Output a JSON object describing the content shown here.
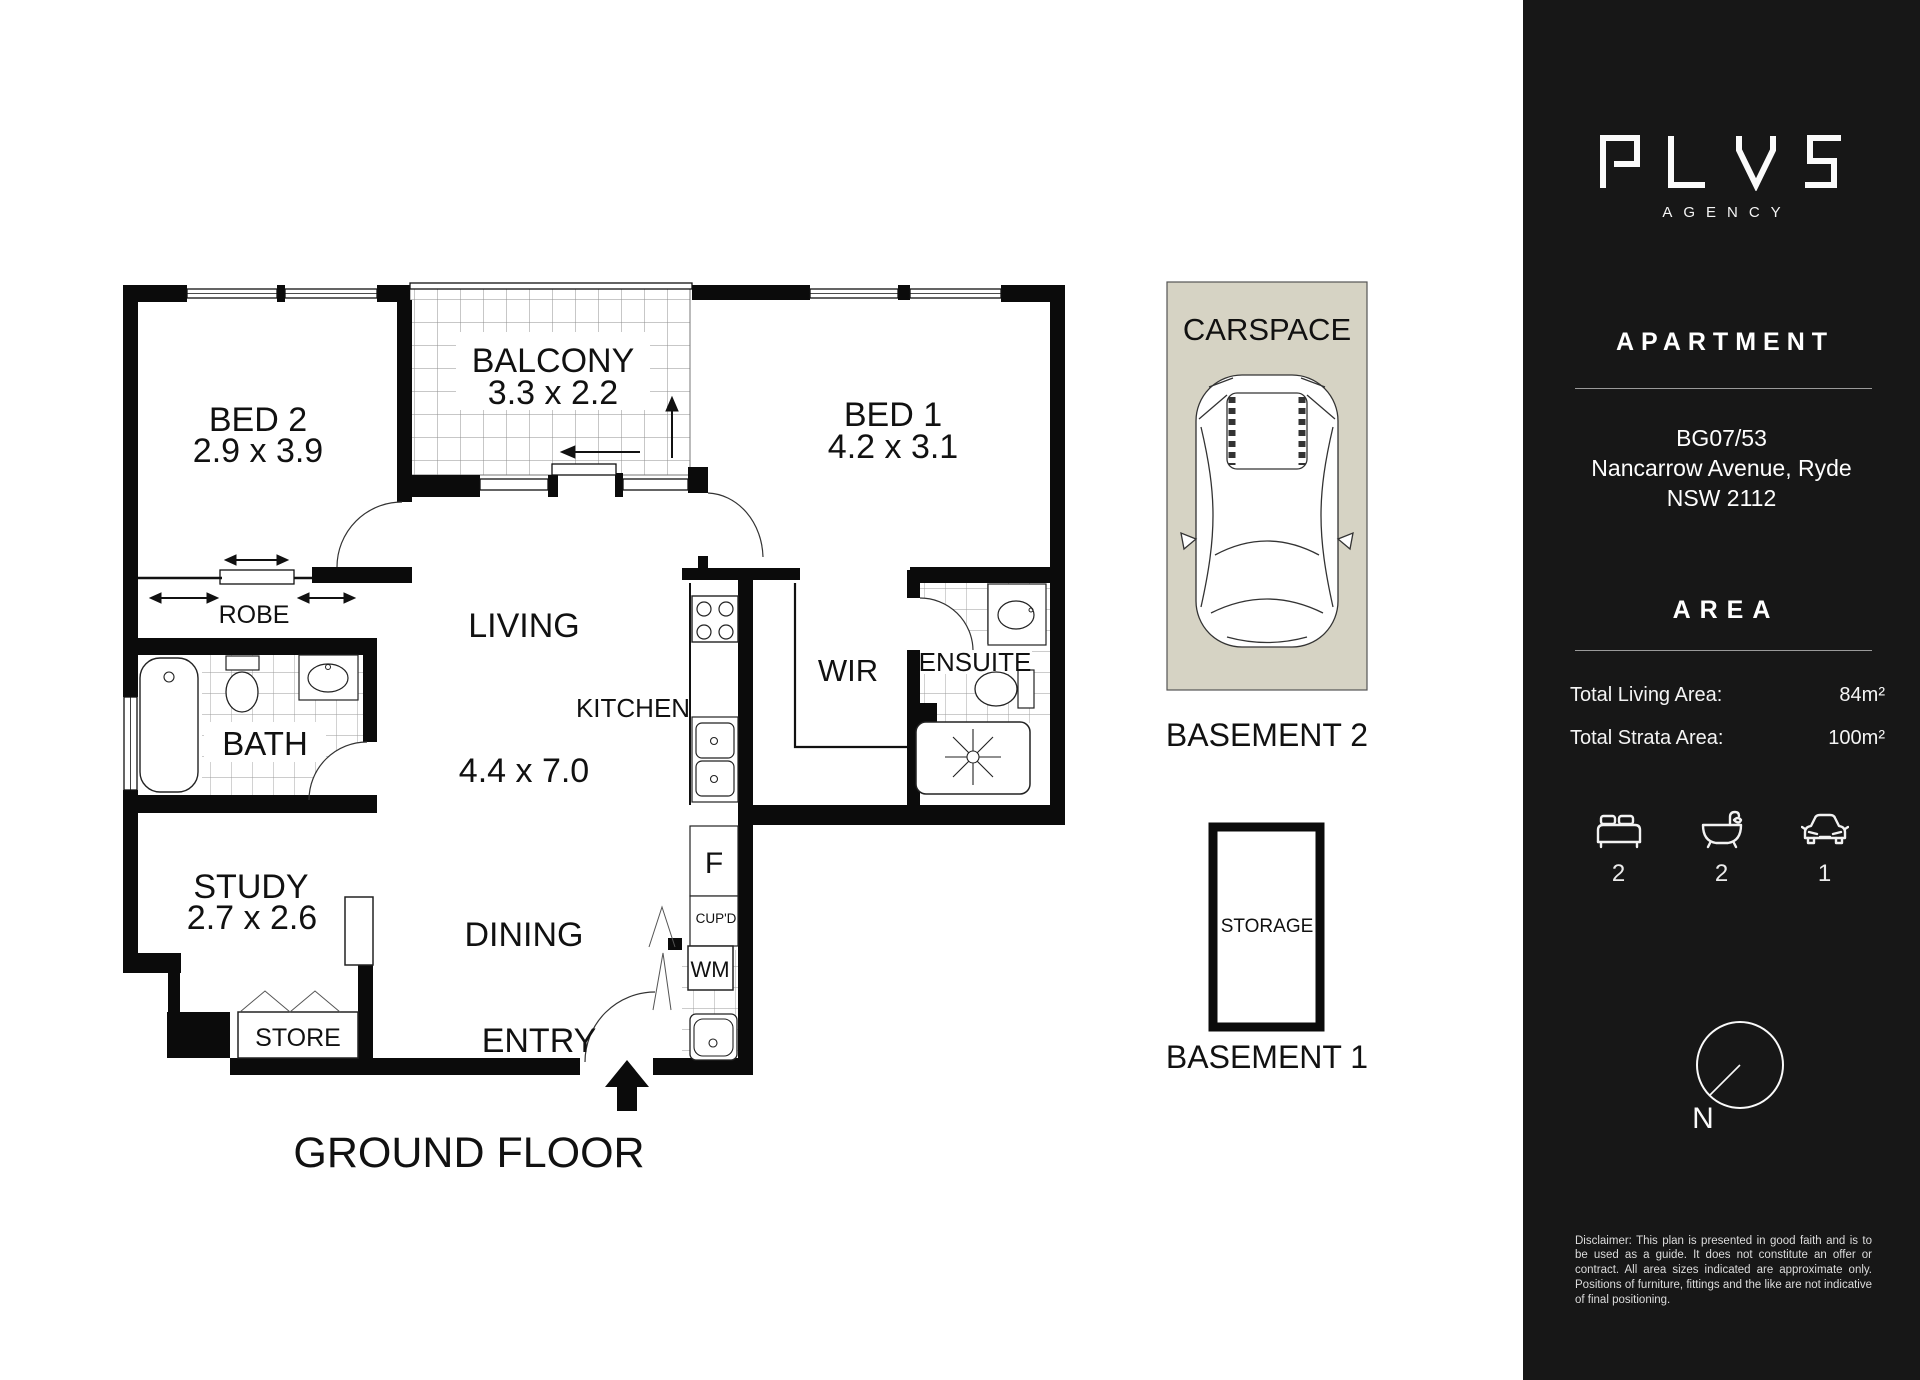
{
  "colors": {
    "sidebar_bg": "#171717",
    "carspace_bg": "#d6d3c4",
    "wall": "#0b0b0b"
  },
  "icons": {
    "brand": "plus-logo-icon",
    "beds": "bed-icon",
    "baths": "bath-icon",
    "cars": "car-icon",
    "compass": "compass-icon",
    "entry": "entry-arrow-icon"
  },
  "plan": {
    "title": "GROUND FLOOR",
    "rooms": {
      "bed2": {
        "label": "BED 2",
        "dims": "2.9 x 3.9"
      },
      "balcony": {
        "label": "BALCONY",
        "dims": "3.3 x 2.2"
      },
      "bed1": {
        "label": "BED 1",
        "dims": "4.2 x 3.1"
      },
      "robe": {
        "label": "ROBE"
      },
      "bath": {
        "label": "BATH"
      },
      "living": {
        "label": "LIVING",
        "dims": "4.4 x 7.0"
      },
      "kitchen": {
        "label": "KITCHEN"
      },
      "wir": {
        "label": "WIR"
      },
      "ensuite": {
        "label": "ENSUITE"
      },
      "study": {
        "label": "STUDY",
        "dims": "2.7 x 2.6"
      },
      "dining": {
        "label": "DINING"
      },
      "store": {
        "label": "STORE"
      },
      "entry": {
        "label": "ENTRY"
      },
      "fridge": {
        "label": "F"
      },
      "cupboard": {
        "label": "CUP'D"
      },
      "washing_machine": {
        "label": "WM"
      }
    },
    "parking": {
      "carspace_label": "CARSPACE",
      "carspace_caption": "BASEMENT 2",
      "storage_label": "STORAGE",
      "storage_caption": "BASEMENT 1"
    }
  },
  "sidebar": {
    "logo": {
      "wordmark": "PLVS",
      "subtitle": "AGENCY"
    },
    "property_type": "APARTMENT",
    "address": {
      "line1": "BG07/53",
      "line2": "Nancarrow Avenue, Ryde",
      "line3": "NSW 2112"
    },
    "area_heading": "AREA",
    "area_rows": [
      {
        "label": "Total Living Area:",
        "value": "84m²"
      },
      {
        "label": "Total Strata Area:",
        "value": "100m²"
      }
    ],
    "stats": {
      "beds": "2",
      "baths": "2",
      "cars": "1"
    },
    "compass_label": "N",
    "disclaimer": "Disclaimer: This plan is presented in good faith and is to be used as a guide. It does not constitute an offer or contract. All area sizes indicated are approximate only. Positions of furniture, fittings and the like are not indicative of final positioning."
  }
}
